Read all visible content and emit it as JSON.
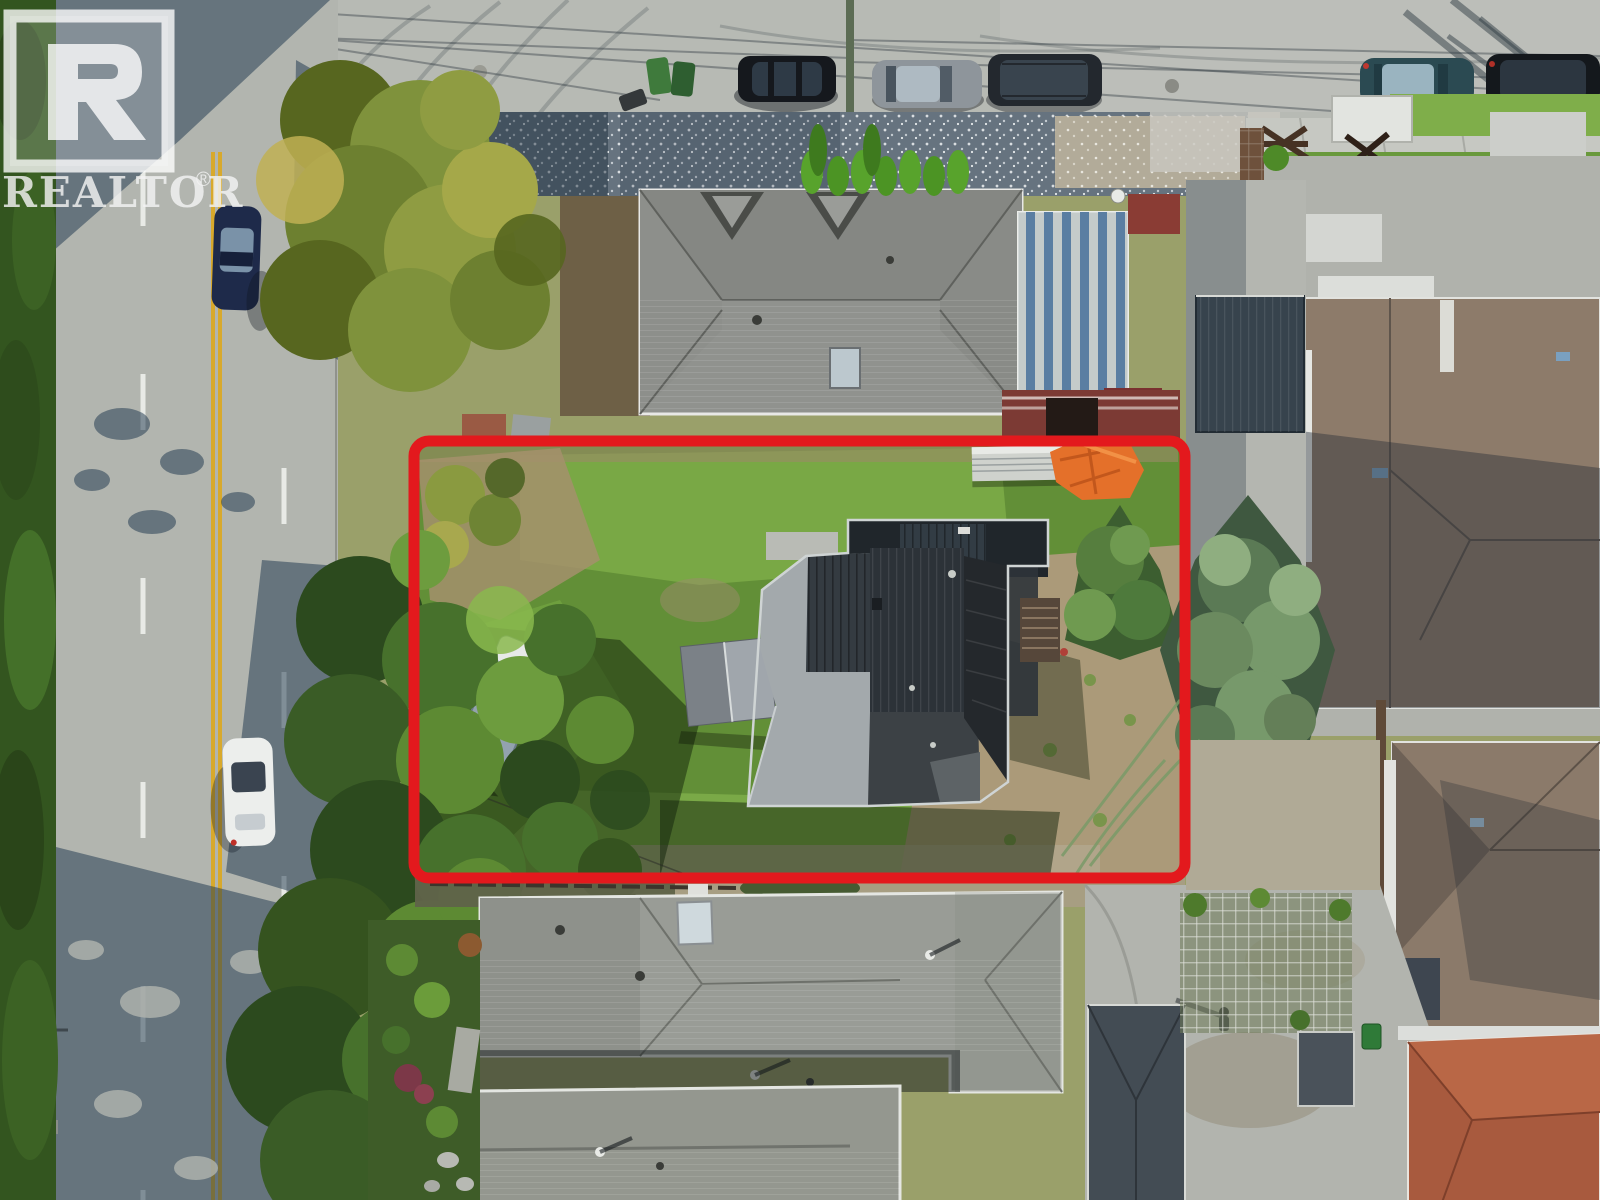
{
  "image": {
    "kind": "aerial-drone-real-estate-photo",
    "width_px": 1600,
    "height_px": 1200
  },
  "watermark": {
    "logo_letter": "R",
    "wordmark": "REALTOR",
    "registered": "®"
  },
  "overlay": {
    "boundary_shape": "rounded-rectangle",
    "boundary_color": "#e3191d"
  },
  "palette": {
    "asphalt_sunlit": "#b7bab4",
    "asphalt_shadow": "#3f5d74",
    "center_line_yellow": "#d8a92c",
    "lane_dash_white": "#e8eae6",
    "grass_sunlit": "#7cab47",
    "grass_base": "#628f37",
    "grass_shadow": "#2c4a1e",
    "dirt_tan": "#ab9a79",
    "gravel_blue_gray": "#66737f",
    "subject_roof_dark": "#2c3238",
    "subject_roof_light_shingle": "#a3a9ac",
    "neighbor_roof_gray": "#93958f",
    "neighbor_roof_tan": "#8d7b6a",
    "terracotta_roof": "#a85a3e",
    "metal_roof_blue": "#5b82a8",
    "metal_roof_white": "#d8dcd8",
    "tarp_orange": "#e4702a",
    "carport_maroon": "#7c3a34",
    "spruce_green": "#77996b",
    "deciduous_green": "#47712c"
  }
}
